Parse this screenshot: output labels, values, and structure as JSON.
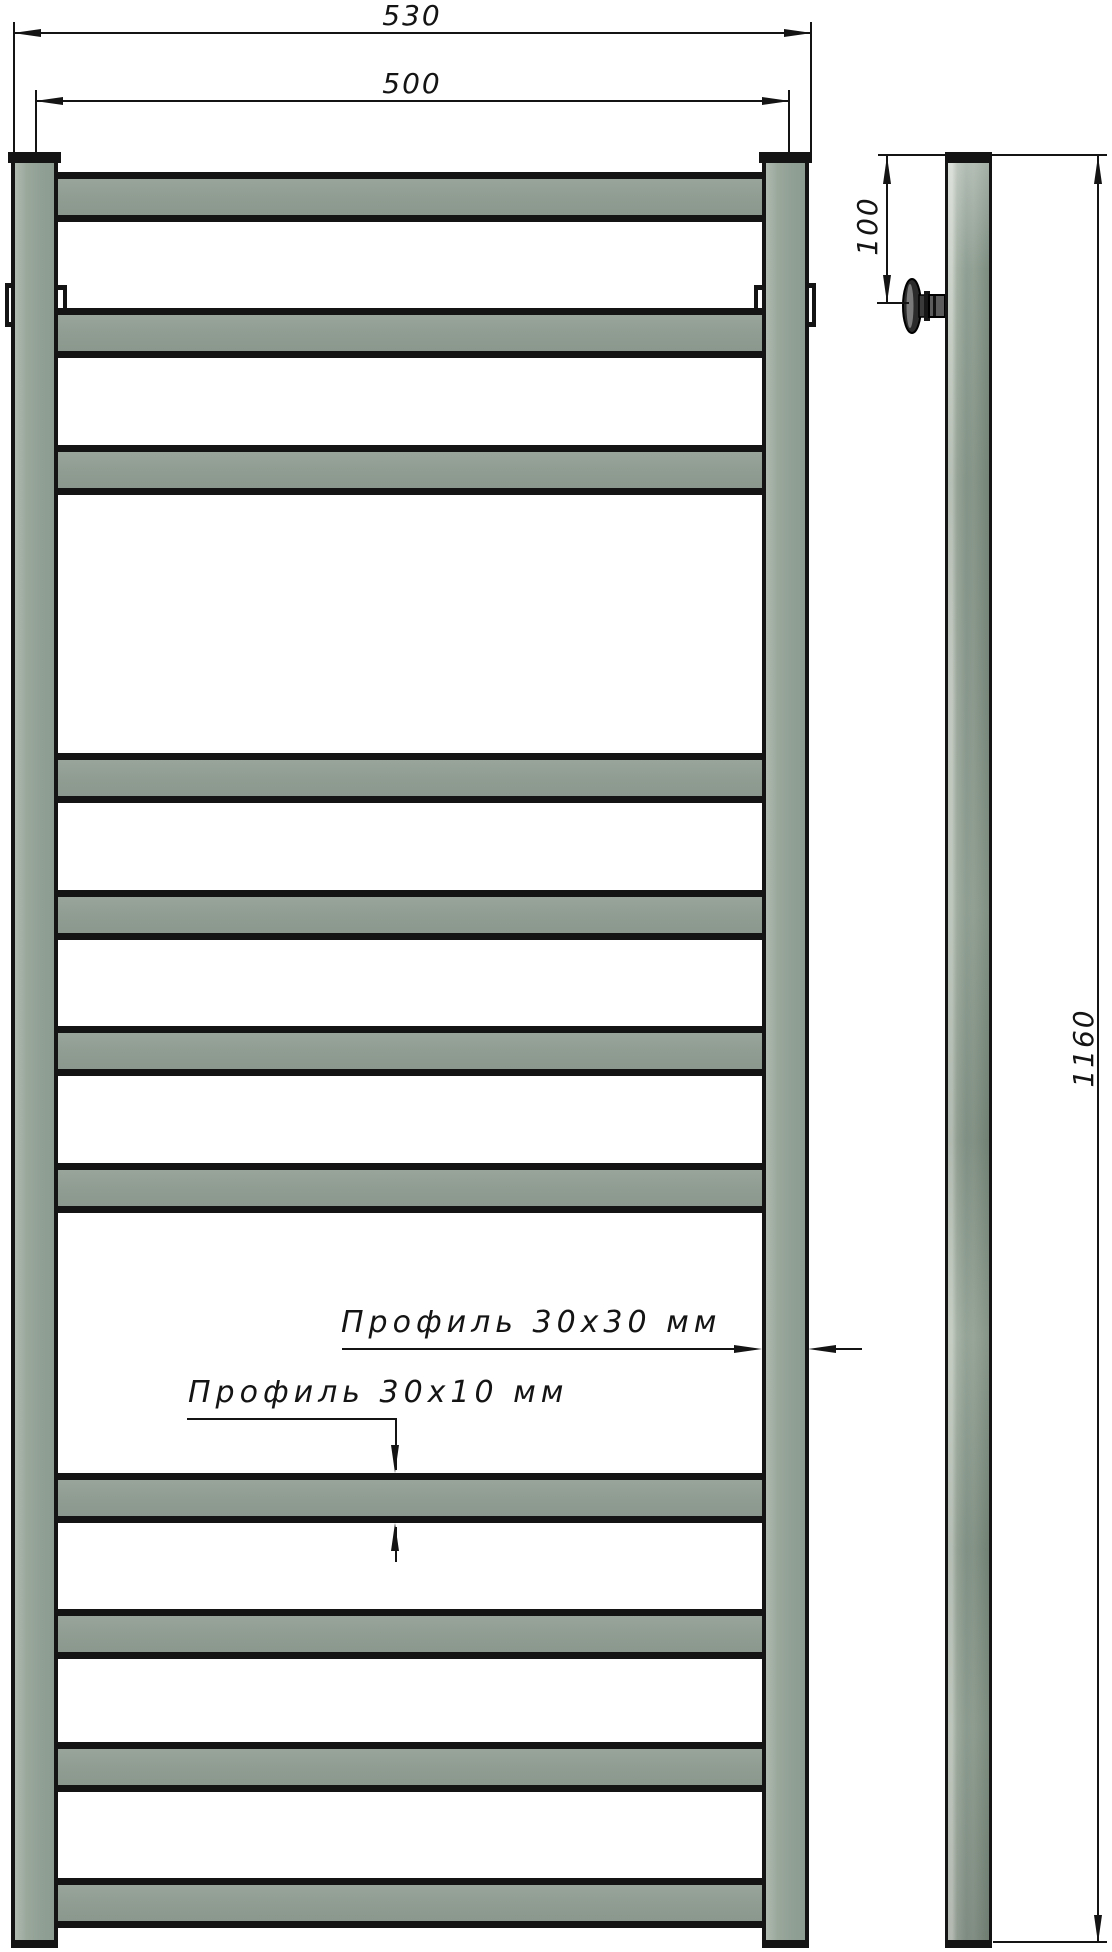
{
  "drawing": {
    "subject": "ladder-towel-rail-technical-drawing",
    "views": {
      "front": "front view",
      "side": "side view"
    },
    "dimensions": {
      "overall_width": "530",
      "mount_center_width": "500",
      "top_to_bracket_offset": "100",
      "overall_height": "1160"
    },
    "callouts": {
      "post_profile": "Профиль 30х30 мм",
      "rung_profile": "Профиль 30х10 мм"
    },
    "front_view": {
      "rung_count": 11,
      "rung_tops": [
        172,
        308,
        445,
        753,
        890,
        1026,
        1163,
        1473,
        1609,
        1742,
        1878
      ]
    },
    "colors": {
      "metal": "#91a095",
      "metal_highlight": "#ccd3ca",
      "outline": "#141414",
      "background": "#ffffff"
    }
  }
}
